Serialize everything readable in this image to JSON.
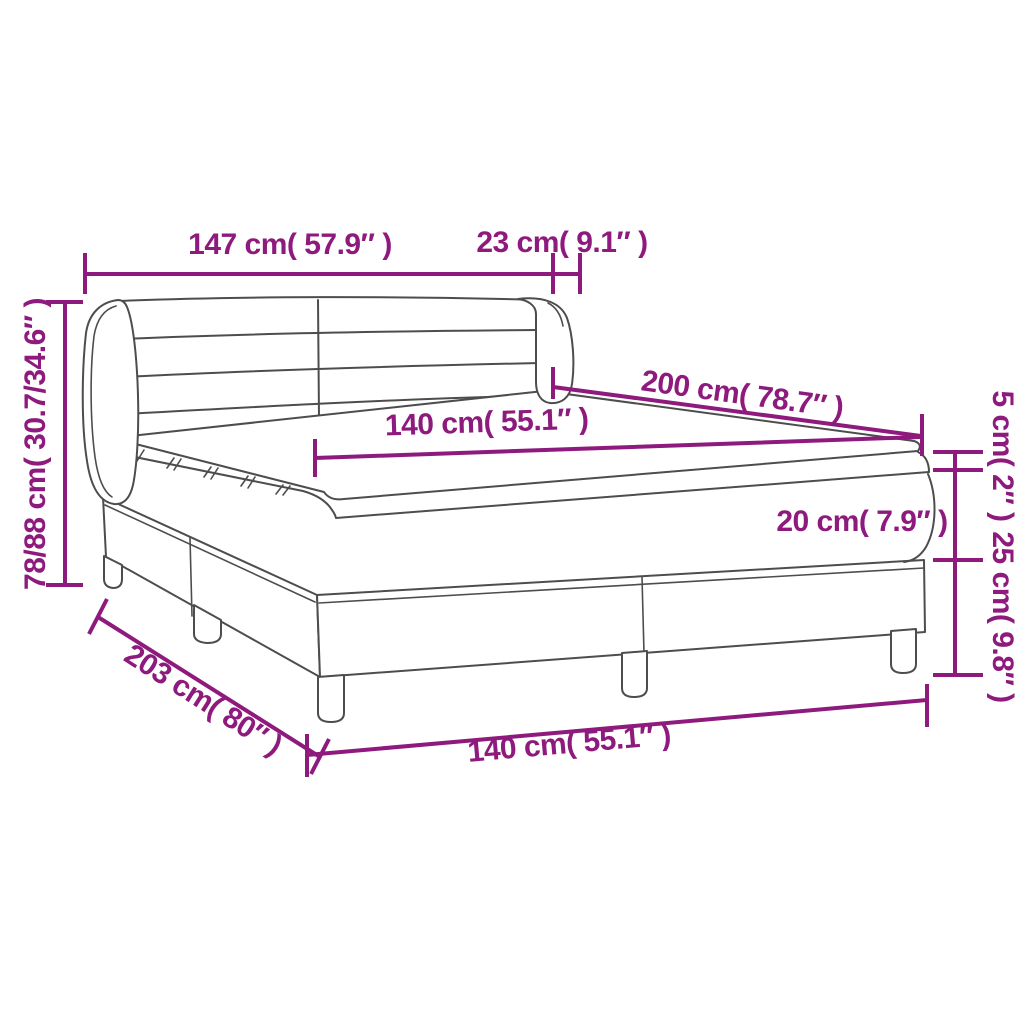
{
  "diagram": {
    "illustration": "box-spring-bed-line-art",
    "colors": {
      "dimension_accent": "#8E1A7D",
      "artwork_line": "#4D4D4D",
      "background": "#FFFFFF"
    },
    "labels": {
      "headboard_width": "147 cm( 57.9″ )",
      "headboard_side_depth": "23 cm( 9.1″ )",
      "overall_height": "78/88 cm( 30.7/34.6″ )",
      "bed_length": "200 cm( 78.7″ )",
      "mattress_width": "140 cm( 55.1″ )",
      "topper_thickness": "5 cm( 2″ )",
      "mattress_thickness": "20 cm( 7.9″ )",
      "base_height": "25 cm( 9.8″ )",
      "base_length": "203 cm( 80″ )",
      "base_width": "140 cm( 55.1″ )"
    }
  }
}
